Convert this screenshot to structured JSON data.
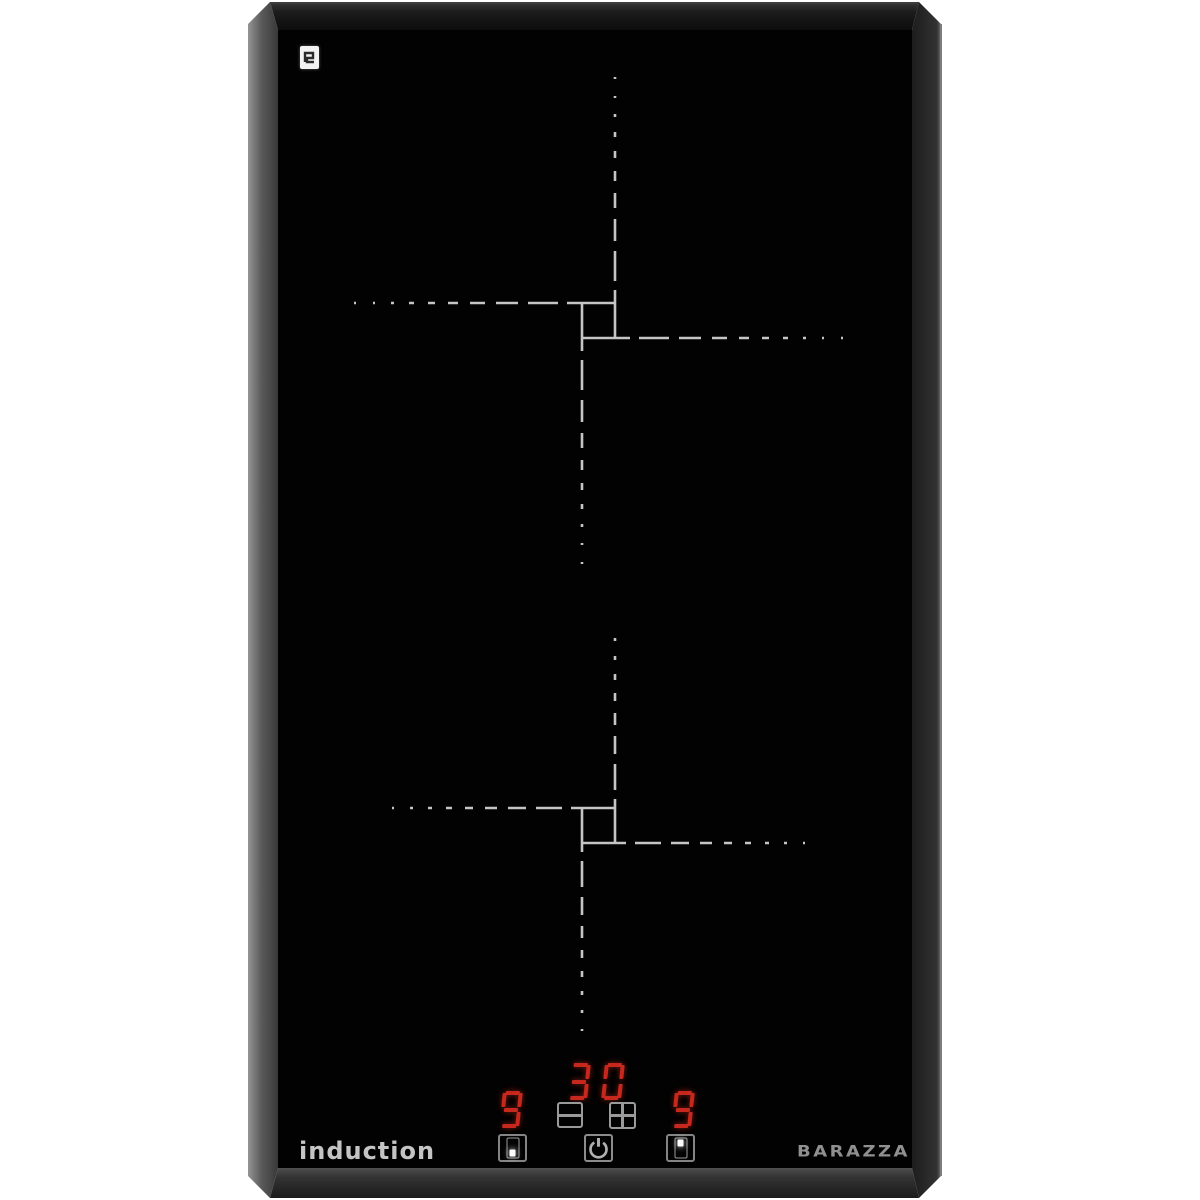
{
  "page": {
    "background": "#ffffff"
  },
  "product": {
    "brand": "BARAZZA",
    "type_label": "induction"
  },
  "surface": {
    "glass_color": "#020202",
    "frame_left_color": "#8a8a8a",
    "frame_top_color": "#1f1f1f",
    "frame_right_color": "#2a2a2a",
    "frame_bottom_color": "#3a3a3a",
    "zone_marking_color": "#d6d6d6"
  },
  "certification_mark": {
    "icon": "approval-mark-icon",
    "background": "#f2f2f2"
  },
  "zones": [
    {
      "name": "rear-zone",
      "marking": "offset dashed cross"
    },
    {
      "name": "front-zone",
      "marking": "offset dashed cross"
    }
  ],
  "controls": {
    "segment_color": "#c6281e",
    "timer_display": "30",
    "left_power_display": "9",
    "right_power_display": "9",
    "minus_button": {
      "icon": "minus-icon"
    },
    "plus_button": {
      "icon": "plus-icon"
    },
    "power_button": {
      "icon": "power-icon"
    },
    "left_zone_button": {
      "icon": "zone-select-front-icon",
      "lit": "bottom"
    },
    "right_zone_button": {
      "icon": "zone-select-rear-icon",
      "lit": "top"
    }
  }
}
